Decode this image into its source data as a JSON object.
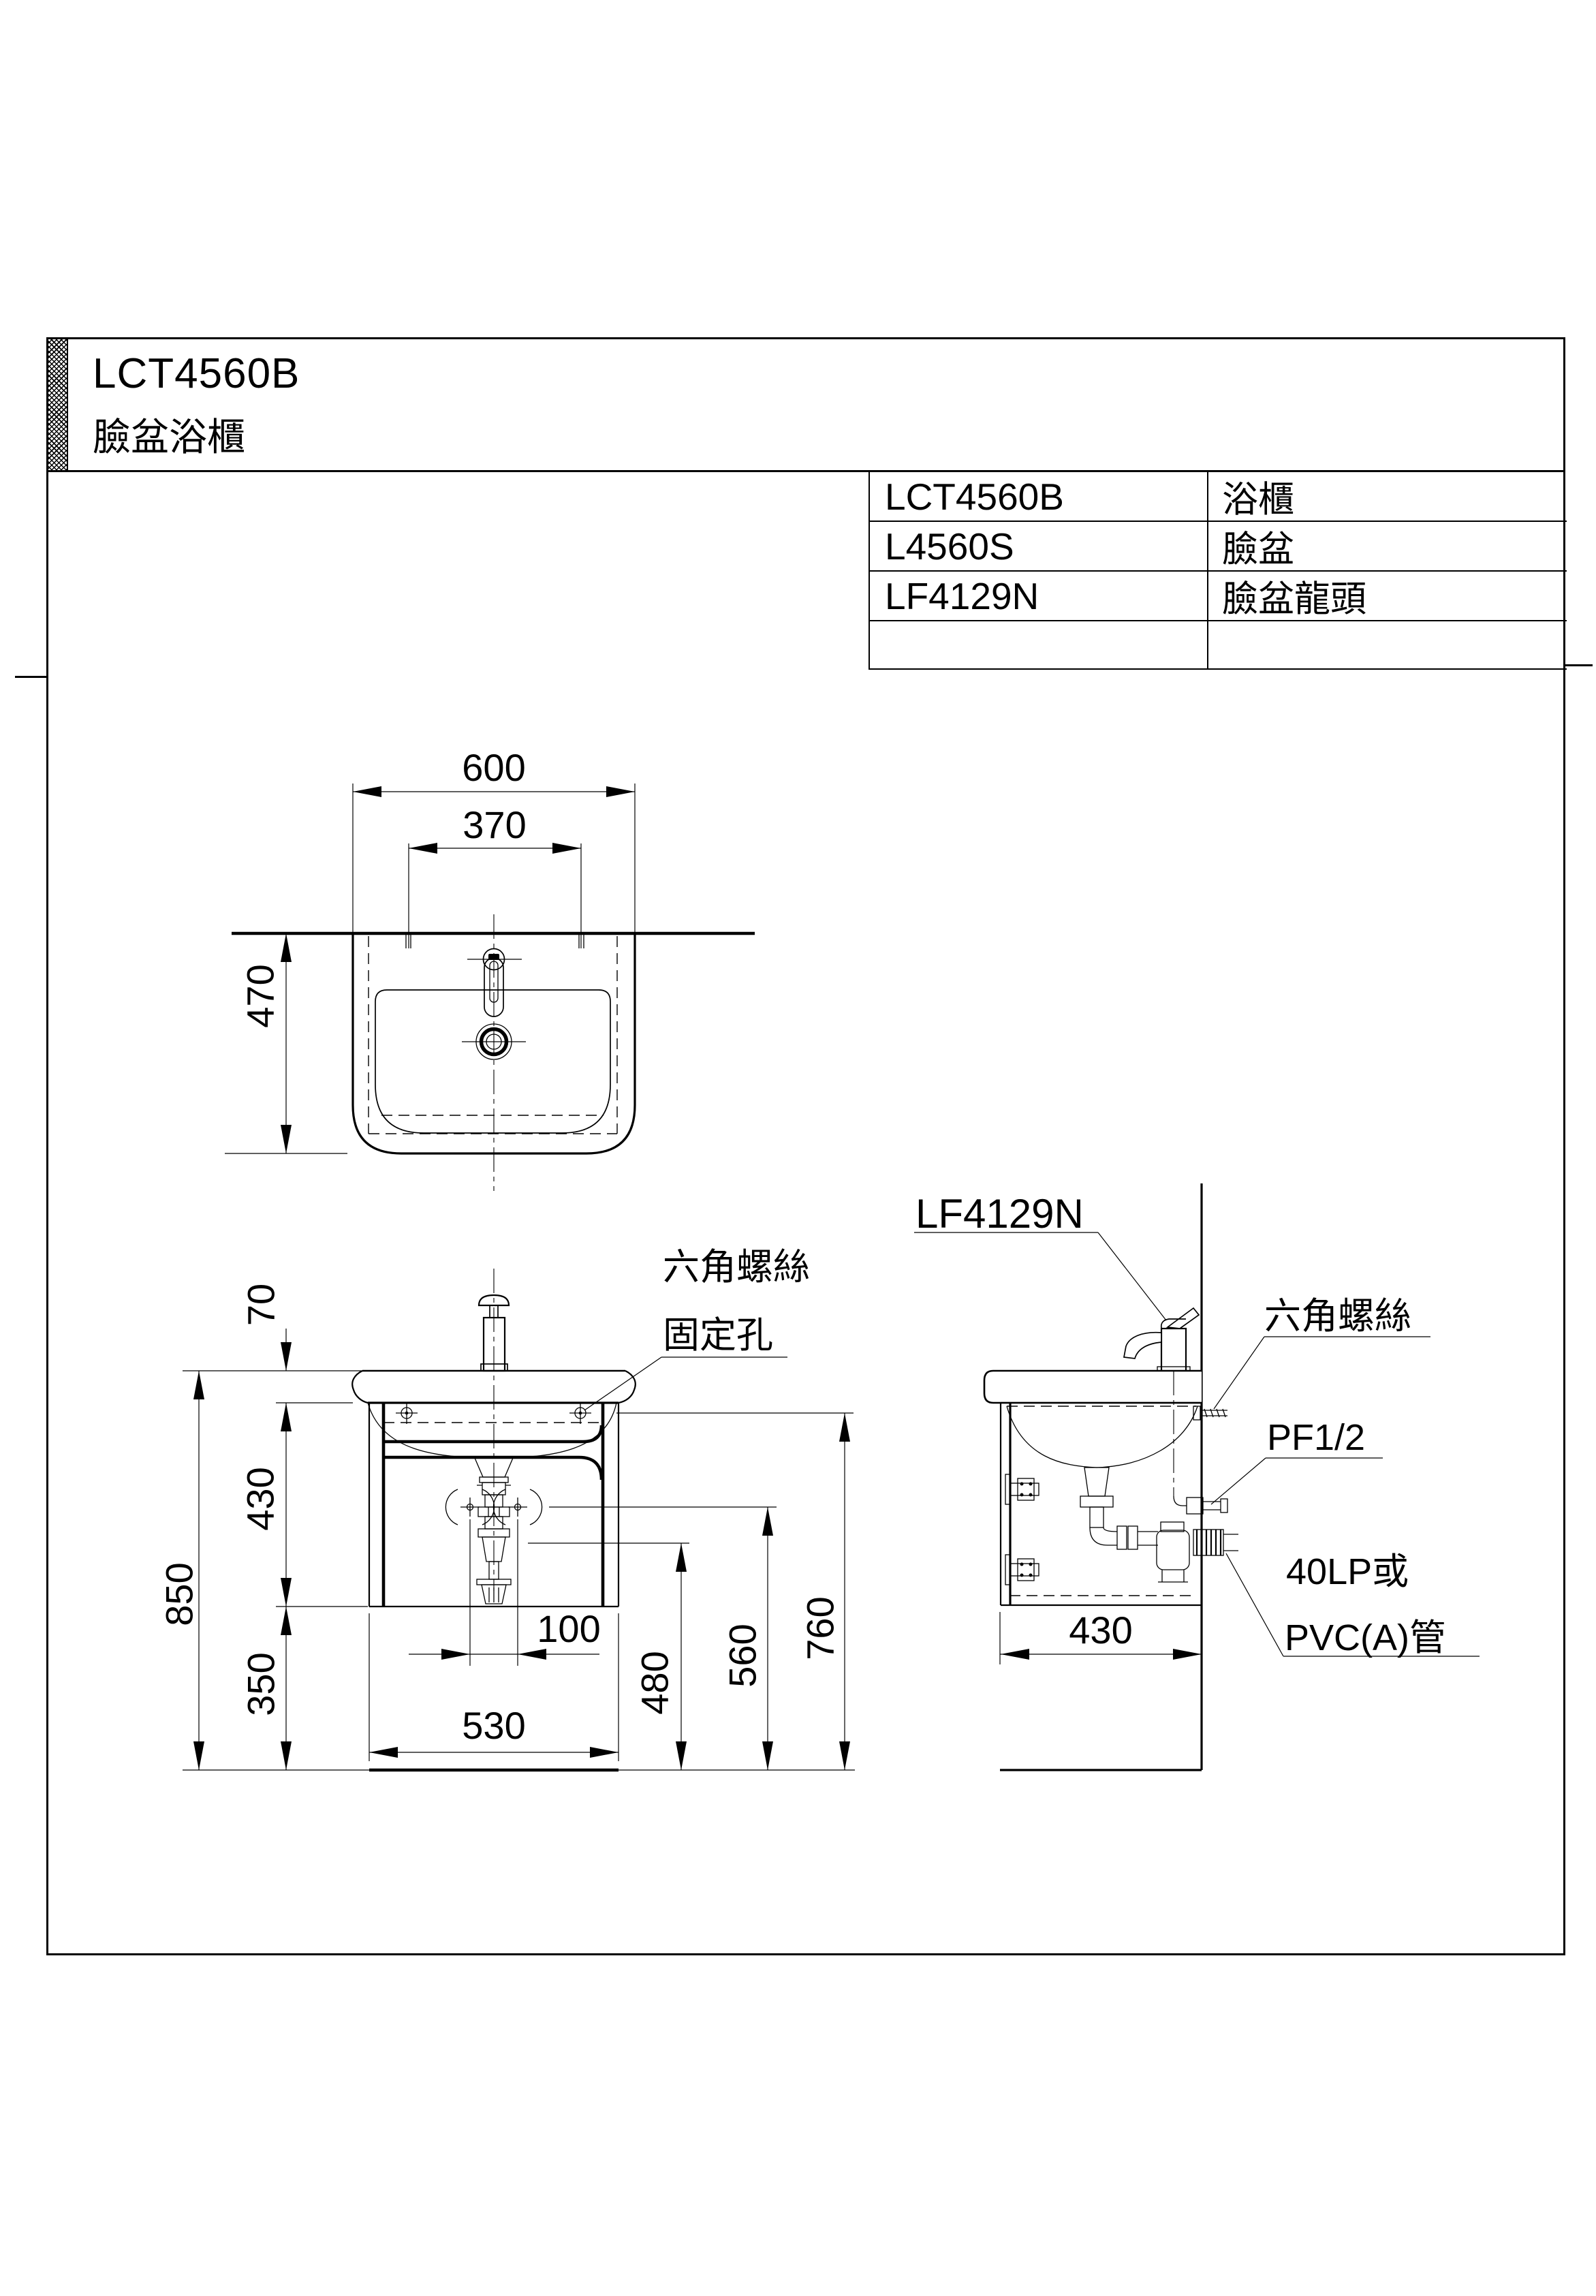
{
  "title_block": {
    "model": "LCT4560B",
    "product_name": "臉盆浴櫃"
  },
  "parts_table": {
    "rows": [
      {
        "code": "LCT4560B",
        "name": "浴櫃"
      },
      {
        "code": "L4560S",
        "name": "臉盆"
      },
      {
        "code": "LF4129N",
        "name": "臉盆龍頭"
      },
      {
        "code": "",
        "name": ""
      }
    ]
  },
  "top_view": {
    "dims": {
      "overall_width": "600",
      "hole_spacing": "370",
      "depth": "470"
    }
  },
  "front_view": {
    "dims": {
      "basin_thickness": "70",
      "cabinet_height": "430",
      "overall_height": "850",
      "floor_clearance": "350",
      "trap_offset": "100",
      "cabinet_width": "530",
      "drain_outlet_height": "480",
      "supply_height": "560",
      "mounting_height": "760"
    },
    "labels": {
      "fixing_note_line1": "六角螺絲",
      "fixing_note_line2": "固定孔"
    }
  },
  "side_view": {
    "dims": {
      "cabinet_depth": "430"
    },
    "labels": {
      "faucet_model": "LF4129N",
      "wall_screw": "六角螺絲",
      "supply_thread": "PF1/2",
      "drain_note_line1": "40LP或",
      "drain_note_line2": "PVC(A)管"
    }
  }
}
